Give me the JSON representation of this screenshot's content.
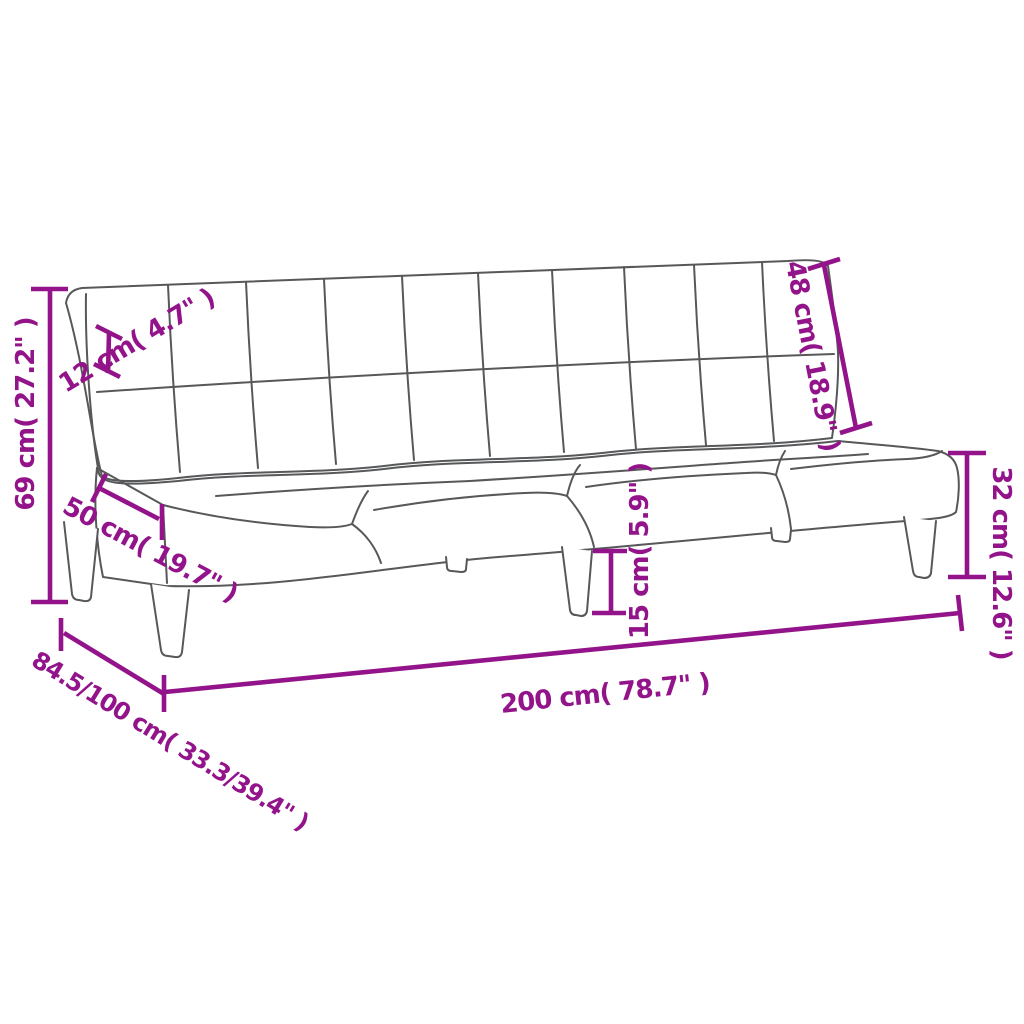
{
  "page": {
    "background": "#ffffff",
    "kind": "product dimension diagram",
    "subject": "armless 2-seater sofa bed line drawing with tufted cushions and tapered legs"
  },
  "style": {
    "dimension_color": "#93148a",
    "outline_color": "#57585a"
  },
  "dimensions": {
    "total_height": {
      "label": "69 cm( 27.2\" )",
      "cm": "69",
      "inches": "27.2"
    },
    "backrest_thickness": {
      "label": "12 cm( 4.7\" )",
      "cm": "12",
      "inches": "4.7"
    },
    "seat_depth": {
      "label": "50 cm( 19.7\" )",
      "cm": "50",
      "inches": "19.7"
    },
    "backrest_length": {
      "label": "48 cm( 18.9\" )",
      "cm": "48",
      "inches": "18.9"
    },
    "seat_height": {
      "label": "32 cm( 12.6\" )",
      "cm": "32",
      "inches": "12.6"
    },
    "leg_height": {
      "label": "15 cm( 5.9\" )",
      "cm": "15",
      "inches": "5.9"
    },
    "total_width": {
      "label": "200 cm( 78.7\" )",
      "cm": "200",
      "inches": "78.7"
    },
    "depth_sofa_bed": {
      "label": "84.5/100 cm( 33.3/39.4\" )",
      "cm": "84.5/100",
      "inches": "33.3/39.4"
    }
  }
}
